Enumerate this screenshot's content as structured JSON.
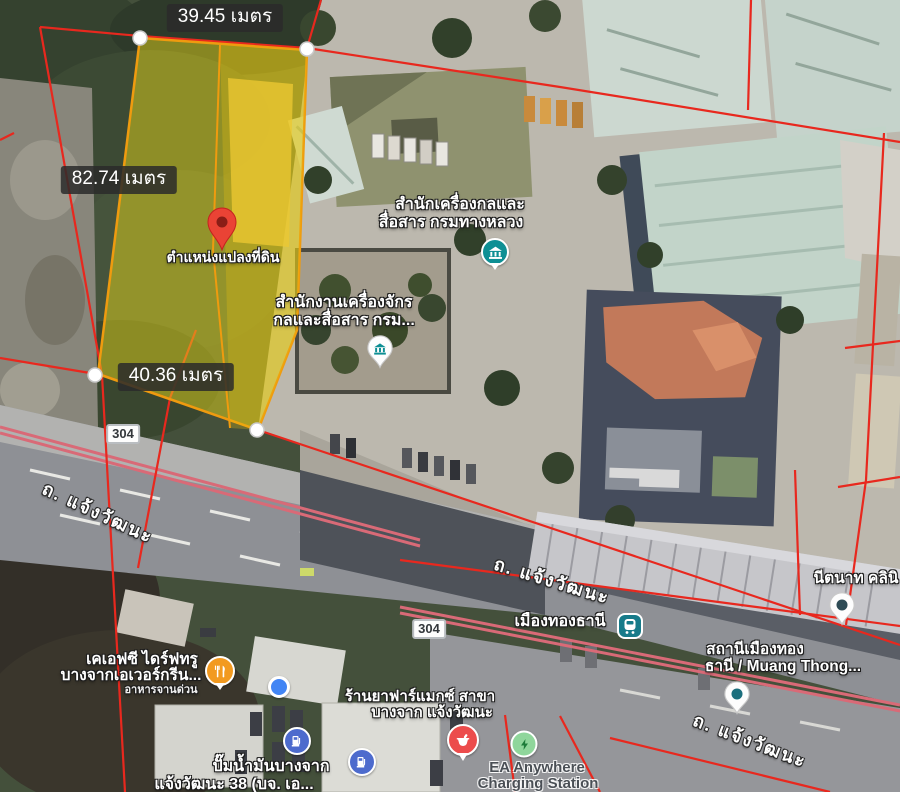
{
  "map_type": "satellite",
  "measurements": {
    "top": "39.45 เมตร",
    "left": "82.74 เมตร",
    "bottom": "40.36 เมตร"
  },
  "pin": {
    "label": "ตำแหน่งแปลงที่ดิน"
  },
  "roads": {
    "chaengwatthana": "ถ. แจ้งวัฒนะ"
  },
  "routes": {
    "number": "304"
  },
  "pois": {
    "gov_office_1": {
      "line1": "สำนักเครื่องกลและ",
      "line2": "สื่อสาร กรมทางหลวง",
      "icon": "government-building-icon"
    },
    "gov_office_2": {
      "line1": "สำนักงานเครื่องจักร",
      "line2": "กลและสื่อสาร กรม...",
      "icon": "government-pin-icon"
    },
    "transit_station": {
      "name": "เมืองทองธานี",
      "icon": "transit-station-icon"
    },
    "station": {
      "line1": "สถานีเมืองทอง",
      "line2": "ธานี / Muang Thong...",
      "icon": "place-pin-icon"
    },
    "clinic": {
      "name": "นีตนาท คลินิ",
      "icon": "place-pin-icon"
    },
    "kfc": {
      "line1": "เคเอฟซี ไดร์ฟทรู",
      "line2": "บางจากเอเวอร์กรีน...",
      "subtitle": "อาหารจานด่วน",
      "icon": "restaurant-icon"
    },
    "pharmacy": {
      "line1": "ร้านยาฟาร์แมกซ์ สาขา",
      "line2": "บางจาก แจ้งวัฒนะ",
      "icon": "pharmacy-icon"
    },
    "ev_charging": {
      "line1": "EA Anywhere",
      "line2": "Charging Station",
      "icon": "ev-charging-icon"
    },
    "gas_station": {
      "line1": "ปั๊มน้ำมันบางจาก",
      "line2": "แจ้งวัฒนะ 38 (บจ. เอ...",
      "icon": "gas-station-icon"
    }
  },
  "colors": {
    "parcel_line_red": "#e8281e",
    "median_pink": "#d96a77",
    "plot_fill_yellow": "#dfd21a",
    "plot_border_orange": "#ef9b0f",
    "pin_red": "#EA4335",
    "gov_teal": "#0e8f94",
    "transit_teal": "#177b8a",
    "restaurant_orange": "#f29a20",
    "pharmacy_red": "#ec4c4c",
    "ev_green": "#8fd69b",
    "gas_blue": "#4d6bcd",
    "location_dot_blue": "#4285F4"
  }
}
